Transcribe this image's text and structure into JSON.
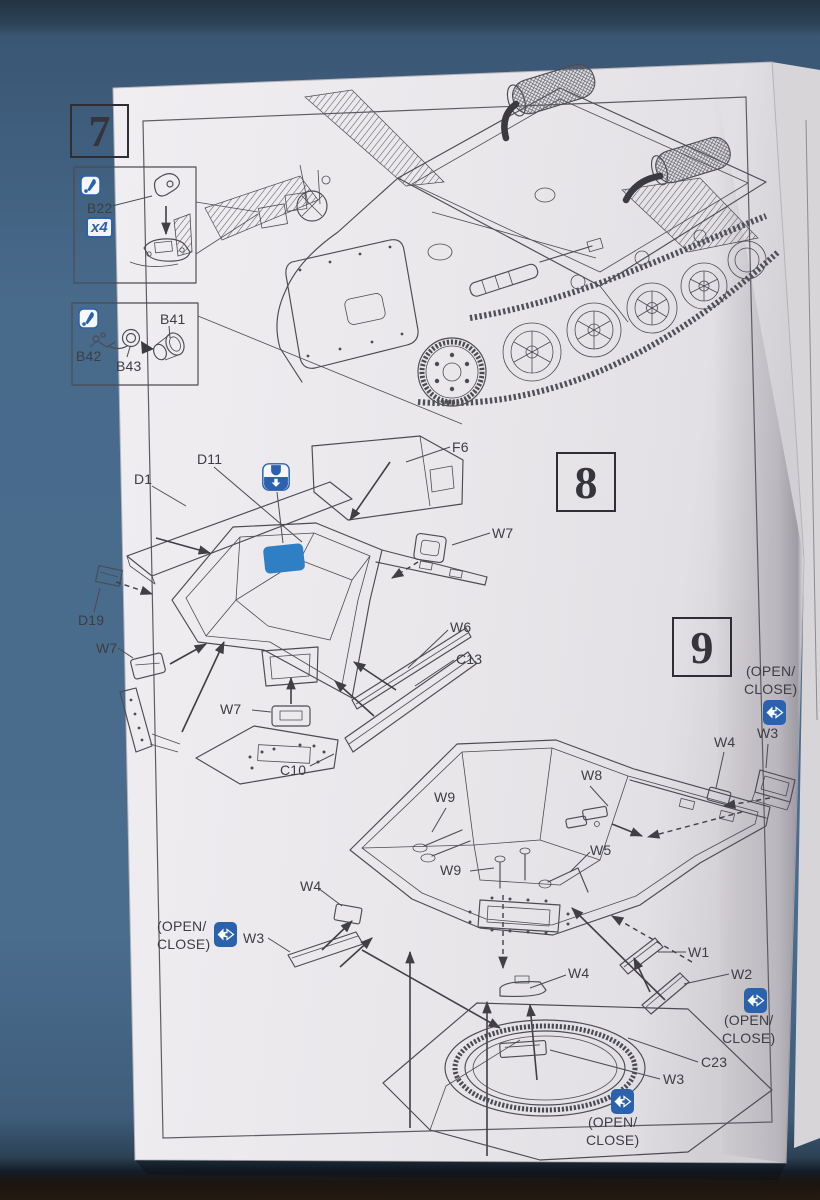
{
  "document": {
    "type": "Model kit assembly instruction sheet",
    "visible_steps": "7-9"
  },
  "colors": {
    "background": "#4a6c8d",
    "paper": "#eceaed",
    "accent_blue": "#2a62ae",
    "decal_highlight_blue": "#2f7fc4",
    "line_art": "#4b4b52",
    "text": "#3d3d44"
  },
  "steps": {
    "step7_number": "7",
    "step8_number": "8",
    "step9_number": "9"
  },
  "step7": {
    "inset1": {
      "part_label": "B22",
      "quantity": "x4",
      "icon": "apply-cement-icon"
    },
    "inset2": {
      "part_b41": "B41",
      "part_b42": "B42",
      "part_b43": "B43",
      "icon": "apply-cement-icon"
    }
  },
  "step8": {
    "labels": {
      "d1": "D1",
      "d11": "D11",
      "f6": "F6",
      "w7": "W7",
      "d19": "D19",
      "w6": "W6",
      "c13": "C13",
      "c10": "C10"
    },
    "icon": "attach-position-icon"
  },
  "step9": {
    "labels": {
      "w1": "W1",
      "w2": "W2",
      "w3": "W3",
      "w4": "W4",
      "w5": "W5",
      "w8": "W8",
      "w9": "W9",
      "c23": "C23"
    },
    "option_note_line1": "(OPEN/",
    "option_note_line2": "CLOSE)",
    "icon": "open-close-option-icon"
  }
}
